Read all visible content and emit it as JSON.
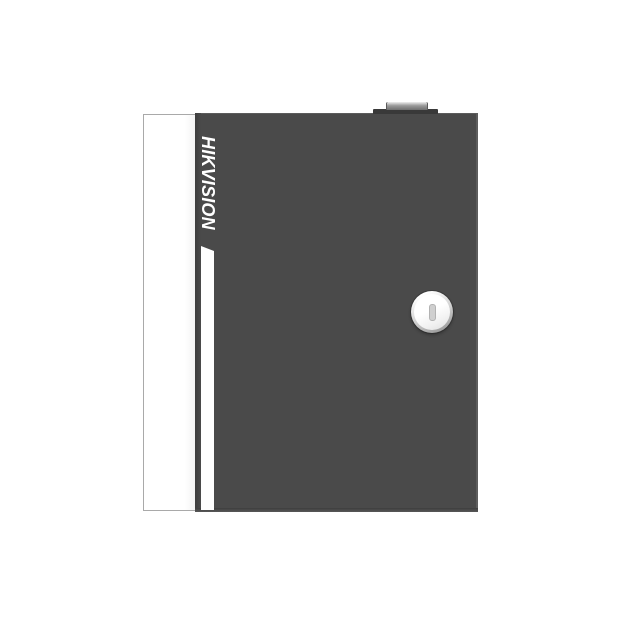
{
  "brand": {
    "logo_text": "HIKVISION"
  },
  "colors": {
    "background": "#ffffff",
    "body": "#4a4a4a",
    "body-top-line": "#5c5c5c",
    "body-right-edge": "#5d5d5d",
    "body-bottom-edge": "#3e3e3e",
    "door-gap": "#3d3d3d",
    "panel": "#ffffff",
    "panel-border": "#a9a9a9",
    "stripe": "#fefefe",
    "logo": "#ffffff",
    "hinge-tab": "#393939",
    "hinge-light": "#efefef",
    "hinge-mid": "#9a9a9a",
    "hinge-dark": "#6e6e6e",
    "lock-ring-light": "#ffffff",
    "lock-ring-dark": "#8a8a8a",
    "lock-face-light": "#ffffff",
    "lock-face-dark": "#dedede",
    "keyhole-fill": "#cfcfcf",
    "keyhole-border": "#b2b2b2"
  }
}
